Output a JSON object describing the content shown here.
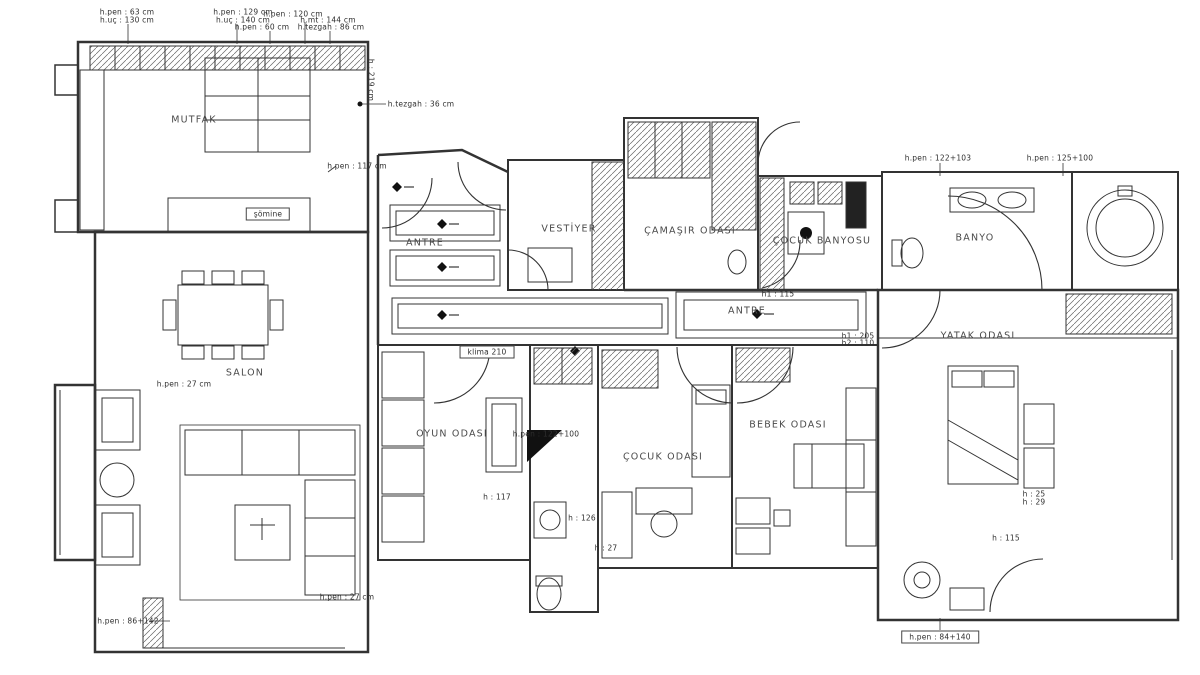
{
  "document": {
    "type": "architectural-floor-plan",
    "style": "black-and-white CAD drawing",
    "background_color": "#ffffff",
    "line_color": "#333333"
  },
  "plan": {
    "room_labels": [
      {
        "text": "MUTFAK",
        "x": 194,
        "y": 120
      },
      {
        "text": "SALON",
        "x": 245,
        "y": 373
      },
      {
        "text": "ANTRE",
        "x": 425,
        "y": 243
      },
      {
        "text": "VESTİYER",
        "x": 569,
        "y": 229
      },
      {
        "text": "ÇAMAŞIR ODASI",
        "x": 690,
        "y": 231
      },
      {
        "text": "ÇOCUK BANYOSU",
        "x": 822,
        "y": 241
      },
      {
        "text": "BANYO",
        "x": 975,
        "y": 238
      },
      {
        "text": "ANTRE",
        "x": 747,
        "y": 311
      },
      {
        "text": "YATAK ODASI",
        "x": 978,
        "y": 336
      },
      {
        "text": "OYUN ODASI",
        "x": 452,
        "y": 434
      },
      {
        "text": "ÇOCUK ODASI",
        "x": 663,
        "y": 457
      },
      {
        "text": "BEBEK ODASI",
        "x": 788,
        "y": 425
      }
    ],
    "annotations": [
      {
        "text": "h.pen : 63 cm",
        "x": 127,
        "y": 12
      },
      {
        "text": "h.uç : 130 cm",
        "x": 127,
        "y": 20
      },
      {
        "text": "h.pen : 129 cm",
        "x": 243,
        "y": 12
      },
      {
        "text": "h.uç : 140 cm",
        "x": 243,
        "y": 20
      },
      {
        "text": "h.pen : 60 cm",
        "x": 262,
        "y": 27
      },
      {
        "text": "h.pen : 120 cm",
        "x": 293,
        "y": 14
      },
      {
        "text": "h.mt : 144 cm",
        "x": 328,
        "y": 20
      },
      {
        "text": "h.tezgah : 86 cm",
        "x": 331,
        "y": 27
      },
      {
        "text": "h : 219 cm",
        "x": 371,
        "y": 80,
        "rotate": 90
      },
      {
        "text": "h.tezgah : 36 cm",
        "x": 421,
        "y": 104
      },
      {
        "text": "h.pen : 117 cm",
        "x": 357,
        "y": 166
      },
      {
        "text": "h.pen : 122+103",
        "x": 938,
        "y": 158
      },
      {
        "text": "h.pen : 125+100",
        "x": 1060,
        "y": 158
      },
      {
        "text": "h1 : 115",
        "x": 778,
        "y": 294
      },
      {
        "text": "h1 : 205",
        "x": 858,
        "y": 336
      },
      {
        "text": "h2 : 110",
        "x": 858,
        "y": 343
      },
      {
        "text": "klima 210",
        "x": 487,
        "y": 352,
        "boxed": true
      },
      {
        "text": "h.pen : 122+100",
        "x": 546,
        "y": 434
      },
      {
        "text": "h : 117",
        "x": 497,
        "y": 497
      },
      {
        "text": "h : 126",
        "x": 582,
        "y": 518
      },
      {
        "text": "h : 27",
        "x": 606,
        "y": 548
      },
      {
        "text": "h.pen : 27 cm",
        "x": 184,
        "y": 384
      },
      {
        "text": "h.pen : 27 cm",
        "x": 347,
        "y": 597
      },
      {
        "text": "h.pen : 86+142",
        "x": 128,
        "y": 621
      },
      {
        "text": "h.pen : 84+140",
        "x": 940,
        "y": 637,
        "boxed": true
      },
      {
        "text": "h : 115",
        "x": 1006,
        "y": 538
      },
      {
        "text": "h : 25",
        "x": 1034,
        "y": 494
      },
      {
        "text": "h : 29",
        "x": 1034,
        "y": 502
      },
      {
        "text": "şömine",
        "x": 268,
        "y": 214,
        "boxed": true
      }
    ]
  }
}
